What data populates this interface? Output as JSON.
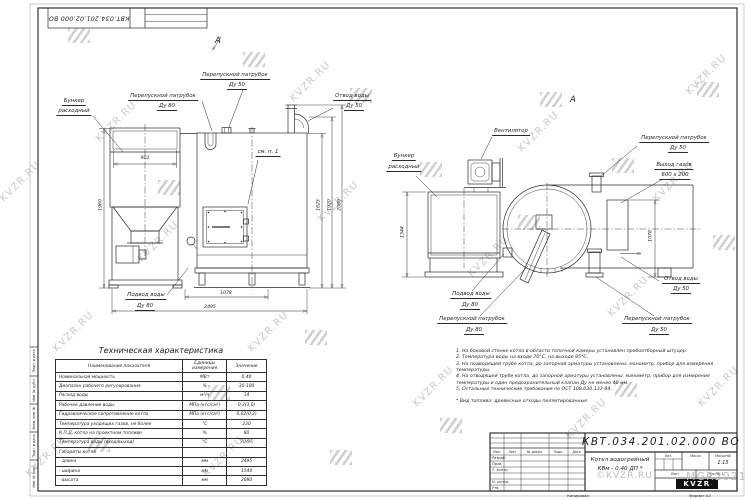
{
  "colors": {
    "line": "#2a2a2a",
    "text": "#1c1c1c",
    "watermark": "#c7cac8",
    "frame": "#222222",
    "logo_bg": "#111111"
  },
  "watermark": {
    "text": "KVZR.RU",
    "copyright": "©KVZR.RU",
    "mark": "MGR2021"
  },
  "corner_stamp": {
    "doc_number": "КВТ.034.201.02.000  ВО"
  },
  "front_view": {
    "view_arrow_label": "А",
    "labels": {
      "hopper_l1": "Бункер",
      "hopper_l2": "расходный",
      "bypass80_l1": "Перепускной патрубок",
      "bypass80_l2": "Ду 80",
      "bypass50_l1": "Перепускной патрубок",
      "bypass50_l2": "Ду 50",
      "water_out_l1": "Отвод воды",
      "water_out_l2": "Ду 50",
      "see_note": "см. п. 1",
      "water_in_l1": "Подвод воды",
      "water_in_l2": "Ду 80"
    },
    "dims": {
      "hopper_width": "902",
      "height_left": "1960",
      "dim_1625": "1625",
      "dim_1920": "1920",
      "dim_2080": "2080",
      "dim_1078": "1078",
      "length": "2495"
    }
  },
  "side_view": {
    "view_label": "А",
    "labels": {
      "fan": "Вентилятор",
      "hopper_l1": "Бункер",
      "hopper_l2": "расходный",
      "bypass50_top_l1": "Перепускной патрубок",
      "bypass50_top_l2": "Ду 50",
      "gas_out_l1": "Выход газов",
      "gas_out_l2": "600 x 200",
      "water_out_l1": "Отвод воды",
      "water_out_l2": "Ду 50",
      "water_in_l1": "Подвод воды",
      "water_in_l2": "Ду 80",
      "bypass80_l1": "Перепускной патрубок",
      "bypass80_l2": "Ду 80",
      "bypass50_bot_l1": "Перепускной патрубок",
      "bypass50_bot_l2": "Ду 50"
    },
    "dims": {
      "width": "1544",
      "dim_1078": "1078"
    }
  },
  "spec_table": {
    "title": "Техническая характеристика",
    "headers": [
      "Наименование показателя",
      "Единицы измерения",
      "Значение"
    ],
    "rows": [
      [
        "Номинальная мощность",
        "МВт",
        "0,40"
      ],
      [
        "Диапазон рабочего регулирования",
        "%",
        "30-100"
      ],
      [
        "Расход воды",
        "м³/ч",
        "14"
      ],
      [
        "Рабочее давление воды",
        "МПа (кгс/см²)",
        "0,3(3,0)"
      ],
      [
        "Гидравлическое сопротивление котла",
        "МПа (кгс/см²)",
        "0,02(0,2)"
      ],
      [
        "Температура уходящих газов, не более",
        "°С",
        "230"
      ],
      [
        "К.П.Д. котла на проектном топливе",
        "%",
        "80"
      ],
      [
        "Температура воды (вход/выход)",
        "°С",
        "70/95"
      ],
      [
        "Габариты котла",
        "",
        ""
      ],
      [
        "   - длина",
        "мм",
        "2495"
      ],
      [
        "   - ширина",
        "мм",
        "1544"
      ],
      [
        "   - высота",
        "мм",
        "2080"
      ]
    ]
  },
  "notes": {
    "items": [
      "1.  На боковой стенке котла в области топочной камеры установлен пробоотборный штуцер.",
      "2.  Температура воды на входе 70°С, на выходе 95°С.",
      "3.  На подводящей трубе котла, до запорной арматуры установлены: манометр, прибор для измерения температуры.",
      "4.  На отводящей трубе котла, до запорной арматуры установлены: манометр, прибор для измерения температуры и один предохранительный клапан Ду не менее 40 мм.",
      "5.  Остальные технические требования по ОСТ 108.030.133-84."
    ],
    "fuel_note": "*  Вид топлива:  древесные отходы пеллетированные"
  },
  "title_block": {
    "doc_number": "КВТ.034.201.02.000  ВО",
    "product_l1": "Котел водогрейный",
    "product_l2": "КВм - 0,40  ДП *",
    "cols": [
      "Изм.",
      "Лист",
      "№ докум.",
      "Подп.",
      "Дата"
    ],
    "roles": [
      "Разраб.",
      "Пров.",
      "Т. контр.",
      "",
      "Н. контр.",
      "Утв."
    ],
    "lit": "Лит.",
    "mass": "Масса",
    "scale": "Масштаб",
    "scale_value": "1:15",
    "sheet": "Лист",
    "sheets": "Листов 1",
    "logo": "KVZR",
    "copied": "Копировал",
    "format": "Формат А3"
  },
  "margin_stamps": [
    "Подп. и дата",
    "Инв. № дубл.",
    "Взам. инв. №",
    "Подп. и дата",
    "Инв. № подл."
  ]
}
